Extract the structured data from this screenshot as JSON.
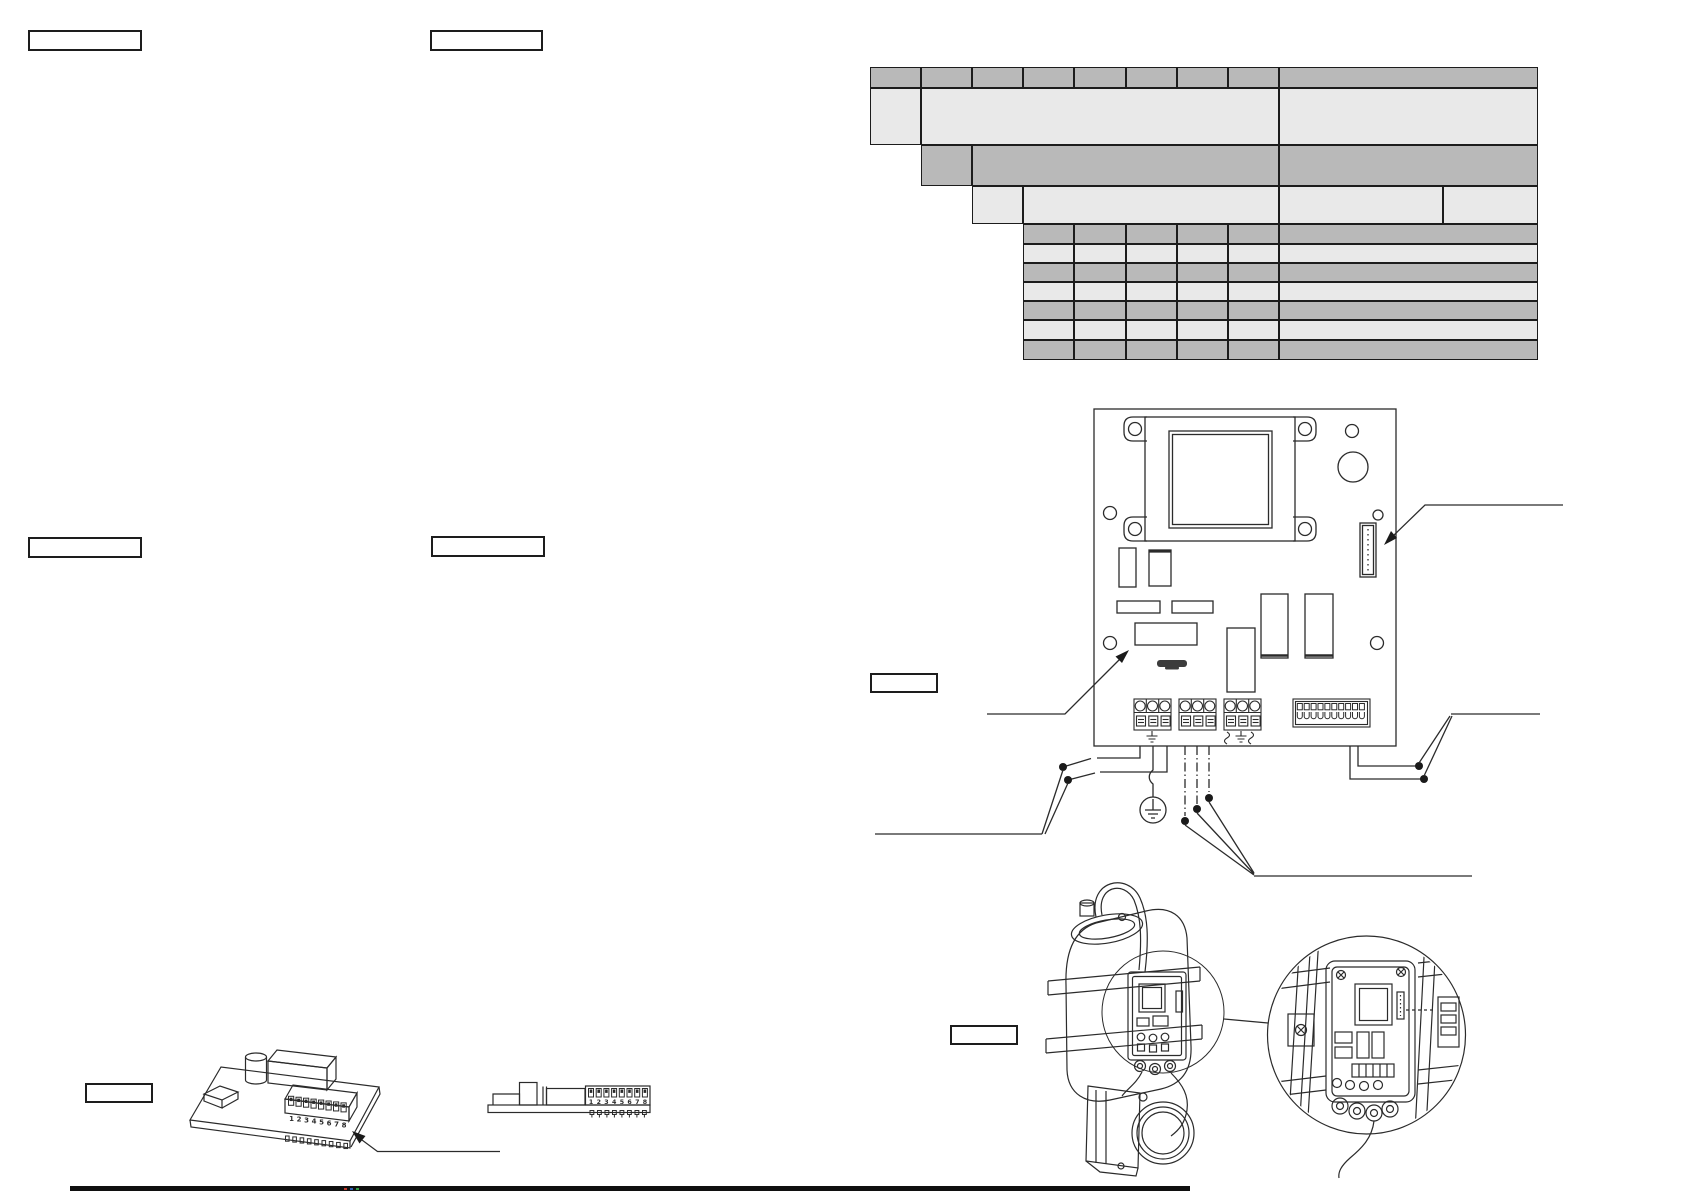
{
  "page": {
    "background": "#ffffff",
    "ink": "#2b2b2b",
    "footer_bar_color": "#101010"
  },
  "labels": {
    "top_left_1": "",
    "top_left_2": "",
    "mid_left_1": "",
    "mid_left_2": "",
    "board_callout": "",
    "iso_pcb_callout": "",
    "device_callout": ""
  },
  "table": {
    "colors": {
      "dark": "#b9b9b9",
      "light": "#e9e9e9",
      "border": "#1c1c1c"
    },
    "rows": [
      {
        "y": 67,
        "h": 21,
        "shade": "dark",
        "cells": [
          [
            870,
            51
          ],
          [
            921,
            51
          ],
          [
            972,
            51
          ],
          [
            1023,
            51
          ],
          [
            1074,
            52
          ],
          [
            1126,
            51
          ],
          [
            1177,
            51
          ],
          [
            1228,
            51
          ],
          [
            1279,
            259
          ]
        ],
        "values": [
          "",
          "",
          "",
          "",
          "",
          "",
          "",
          "",
          ""
        ]
      },
      {
        "y": 88,
        "h": 57,
        "shade": "light",
        "cells": [
          [
            870,
            51
          ],
          [
            921,
            358
          ],
          [
            1279,
            259
          ]
        ],
        "values": [
          "",
          "",
          ""
        ]
      },
      {
        "y": 145,
        "h": 41,
        "shade": "dark",
        "cells": [
          [
            921,
            51
          ],
          [
            972,
            307
          ],
          [
            1279,
            259
          ]
        ],
        "values": [
          "",
          "",
          ""
        ]
      },
      {
        "y": 186,
        "h": 38,
        "shade": "light",
        "cells": [
          [
            972,
            51
          ],
          [
            1023,
            256
          ],
          [
            1279,
            164
          ],
          [
            1443,
            95
          ]
        ],
        "values": [
          "",
          "",
          "",
          ""
        ]
      },
      {
        "y": 224,
        "h": 20,
        "shade": "dark",
        "cells": [
          [
            1023,
            51
          ],
          [
            1074,
            52
          ],
          [
            1126,
            51
          ],
          [
            1177,
            51
          ],
          [
            1228,
            51
          ],
          [
            1279,
            259
          ]
        ],
        "values": [
          "",
          "",
          "",
          "",
          "",
          ""
        ]
      },
      {
        "y": 244,
        "h": 19,
        "shade": "light",
        "cells": [
          [
            1023,
            51
          ],
          [
            1074,
            52
          ],
          [
            1126,
            51
          ],
          [
            1177,
            51
          ],
          [
            1228,
            51
          ],
          [
            1279,
            259
          ]
        ],
        "values": [
          "",
          "",
          "",
          "",
          "",
          ""
        ]
      },
      {
        "y": 263,
        "h": 19,
        "shade": "dark",
        "cells": [
          [
            1023,
            51
          ],
          [
            1074,
            52
          ],
          [
            1126,
            51
          ],
          [
            1177,
            51
          ],
          [
            1228,
            51
          ],
          [
            1279,
            259
          ]
        ],
        "values": [
          "",
          "",
          "",
          "",
          "",
          ""
        ]
      },
      {
        "y": 282,
        "h": 19,
        "shade": "light",
        "cells": [
          [
            1023,
            51
          ],
          [
            1074,
            52
          ],
          [
            1126,
            51
          ],
          [
            1177,
            51
          ],
          [
            1228,
            51
          ],
          [
            1279,
            259
          ]
        ],
        "values": [
          "",
          "",
          "",
          "",
          "",
          ""
        ]
      },
      {
        "y": 301,
        "h": 19,
        "shade": "dark",
        "cells": [
          [
            1023,
            51
          ],
          [
            1074,
            52
          ],
          [
            1126,
            51
          ],
          [
            1177,
            51
          ],
          [
            1228,
            51
          ],
          [
            1279,
            259
          ]
        ],
        "values": [
          "",
          "",
          "",
          "",
          "",
          ""
        ]
      },
      {
        "y": 320,
        "h": 20,
        "shade": "light",
        "cells": [
          [
            1023,
            51
          ],
          [
            1074,
            52
          ],
          [
            1126,
            51
          ],
          [
            1177,
            51
          ],
          [
            1228,
            51
          ],
          [
            1279,
            259
          ]
        ],
        "values": [
          "",
          "",
          "",
          "",
          "",
          ""
        ]
      },
      {
        "y": 340,
        "h": 20,
        "shade": "dark",
        "cells": [
          [
            1023,
            51
          ],
          [
            1074,
            52
          ],
          [
            1126,
            51
          ],
          [
            1177,
            51
          ],
          [
            1228,
            51
          ],
          [
            1279,
            259
          ]
        ],
        "values": [
          "",
          "",
          "",
          "",
          "",
          ""
        ]
      }
    ]
  },
  "figures": {
    "dip_digits": [
      "1",
      "2",
      "3",
      "4",
      "5",
      "6",
      "7",
      "8"
    ],
    "terminal_block_xs": [
      1134,
      1179,
      1224
    ],
    "strip_units": 10,
    "iso_pins": 9,
    "side_pins": 8
  }
}
